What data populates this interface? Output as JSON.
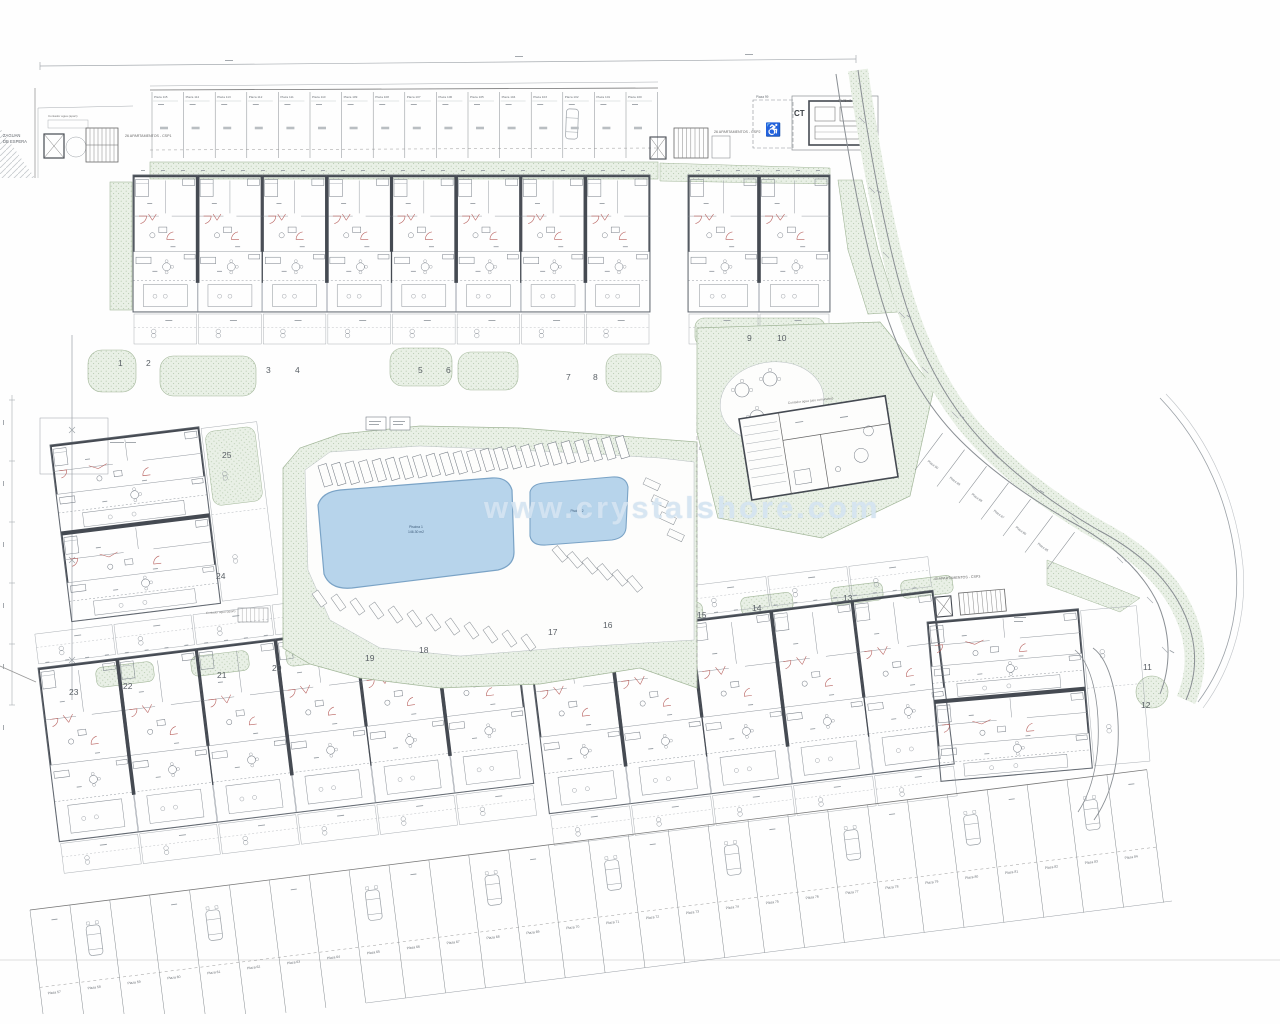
{
  "plan": {
    "watermark": "www.crystalshore.com",
    "development_labels": {
      "csp1": "26 APARTAMENTOS - CSP1",
      "csp2": "26 APARTAMENTOS - CSP2",
      "csp3": "40 APARTAMENTOS - CSP3"
    },
    "annotations": {
      "zaguan_line1": "ZAGUAN",
      "zaguan_line2": "DE ESPERA",
      "ct": "CT",
      "ct_area": "22.75m2",
      "contador_entry": "Contador agua (apart)",
      "contador_comunales": "Contador agua (uso comunales)",
      "contador_south": "Contador agua (apart)",
      "pool1_name": "Piscina 1",
      "pool1_area": "146.30 m2",
      "pool2_name": "Piscina 2"
    },
    "parking": {
      "top_row": [
        "Plaza 115",
        "Plaza 114",
        "Plaza 113",
        "Plaza 112",
        "Plaza 111",
        "Plaza 110",
        "Plaza 109",
        "Plaza 108",
        "Plaza 107",
        "Plaza 106",
        "Plaza 105",
        "Plaza 104",
        "Plaza 103",
        "Plaza 102",
        "Plaza 101",
        "Plaza 100"
      ],
      "handicap_stall": "Plaza 99",
      "curve_stalls": [
        "Plaza 90",
        "Plaza 89",
        "Plaza 88",
        "Plaza 87",
        "Plaza 86",
        "Plaza 85"
      ],
      "bottom_row": [
        "Plaza 57",
        "Plaza 58",
        "Plaza 59",
        "Plaza 60",
        "Plaza 61",
        "Plaza 62",
        "Plaza 63",
        "Plaza 64",
        "Plaza 65",
        "Plaza 66",
        "Plaza 67",
        "Plaza 68",
        "Plaza 69",
        "Plaza 70",
        "Plaza 71",
        "Plaza 72",
        "Plaza 73",
        "Plaza 74",
        "Plaza 75",
        "Plaza 76",
        "Plaza 77",
        "Plaza 78",
        "Plaza 79",
        "Plaza 80",
        "Plaza 81",
        "Plaza 82",
        "Plaza 83",
        "Plaza 84"
      ]
    },
    "blocks": {
      "top": [
        "1",
        "2",
        "3",
        "4",
        "5",
        "6",
        "7",
        "8"
      ],
      "top_right": [
        "9",
        "10"
      ],
      "left": [
        "25",
        "24"
      ],
      "bottom_left": [
        "23",
        "22",
        "21",
        "20",
        "19",
        "18"
      ],
      "bottom_mid": [
        "17",
        "16",
        "15",
        "14",
        "13"
      ],
      "bottom_right": [
        "11",
        "12"
      ]
    },
    "colors": {
      "wall_dark": "#454a52",
      "line": "#8b9198",
      "outline": "#6f757d",
      "green_fill": "#e9f0e6",
      "green_dot": "#b6c9ae",
      "green_edge": "#a3b79a",
      "pool_fill": "#b7d4eb",
      "pool_edge": "#7aa3c6",
      "pool_text": "#3c5a78",
      "red": "#b75f5c",
      "road": "#8a8f94",
      "number": "#5a6066",
      "label": "#6b7076",
      "dim": "#a6abb0"
    }
  }
}
